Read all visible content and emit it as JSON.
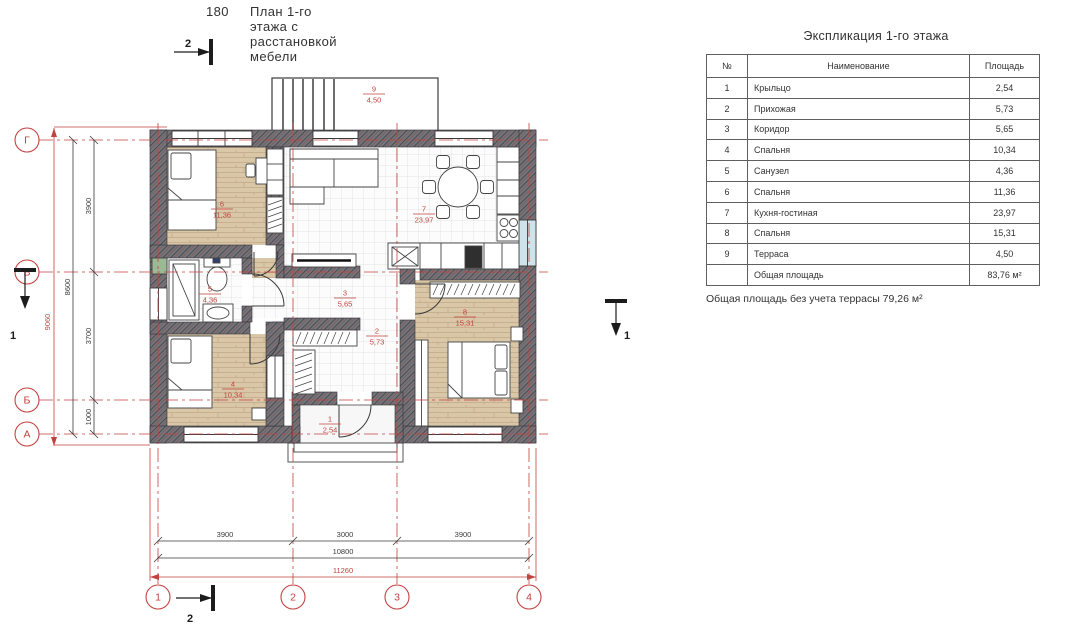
{
  "page_title": {
    "sheet_number": "180",
    "text": "План 1-го этажа с расстановкой мебели"
  },
  "legend": {
    "title": "Экспликация 1-го этажа",
    "columns": {
      "num": "№",
      "name": "Наименование",
      "area": "Площадь"
    },
    "rows": [
      {
        "num": "1",
        "name": "Крыльцо",
        "area": "2,54"
      },
      {
        "num": "2",
        "name": "Прихожая",
        "area": "5,73"
      },
      {
        "num": "3",
        "name": "Коридор",
        "area": "5,65"
      },
      {
        "num": "4",
        "name": "Спальня",
        "area": "10,34"
      },
      {
        "num": "5",
        "name": "Санузел",
        "area": "4,36"
      },
      {
        "num": "6",
        "name": "Спальня",
        "area": "11,36"
      },
      {
        "num": "7",
        "name": "Кухня-гостиная",
        "area": "23,97"
      },
      {
        "num": "8",
        "name": "Спальня",
        "area": "15,31"
      },
      {
        "num": "9",
        "name": "Терраса",
        "area": "4,50"
      }
    ],
    "total_label": "Общая площадь",
    "total_value": "83,76 м²",
    "note": "Общая площадь без учета террасы 79,26 м²"
  },
  "plan": {
    "rooms": [
      {
        "num": "1",
        "area": "2,54"
      },
      {
        "num": "2",
        "area": "5,73"
      },
      {
        "num": "3",
        "area": "5,65"
      },
      {
        "num": "4",
        "area": "10,34"
      },
      {
        "num": "5",
        "area": "4,36"
      },
      {
        "num": "6",
        "area": "11,36"
      },
      {
        "num": "7",
        "area": "23,97"
      },
      {
        "num": "8",
        "area": "15,31"
      },
      {
        "num": "9",
        "area": "4,50"
      }
    ],
    "axes": {
      "rows": [
        "Г",
        "В",
        "Б",
        "А"
      ],
      "cols": [
        "1",
        "2",
        "3",
        "4"
      ]
    },
    "dims": {
      "left": [
        "3900",
        "3700",
        "1000"
      ],
      "left_sum": "8600",
      "left_overall": "9060",
      "bottom": [
        "3900",
        "3000",
        "3900"
      ],
      "bottom_sum": "10800",
      "bottom_overall": "11260"
    },
    "sections": {
      "cut_horizontal": "1",
      "cut_vertical": "2"
    },
    "colors": {
      "accent_red": "#c3423f",
      "wall_gray": "#73737a",
      "wood_floor": "#d9c7a7",
      "dim_text": "#3a3a3a"
    }
  }
}
